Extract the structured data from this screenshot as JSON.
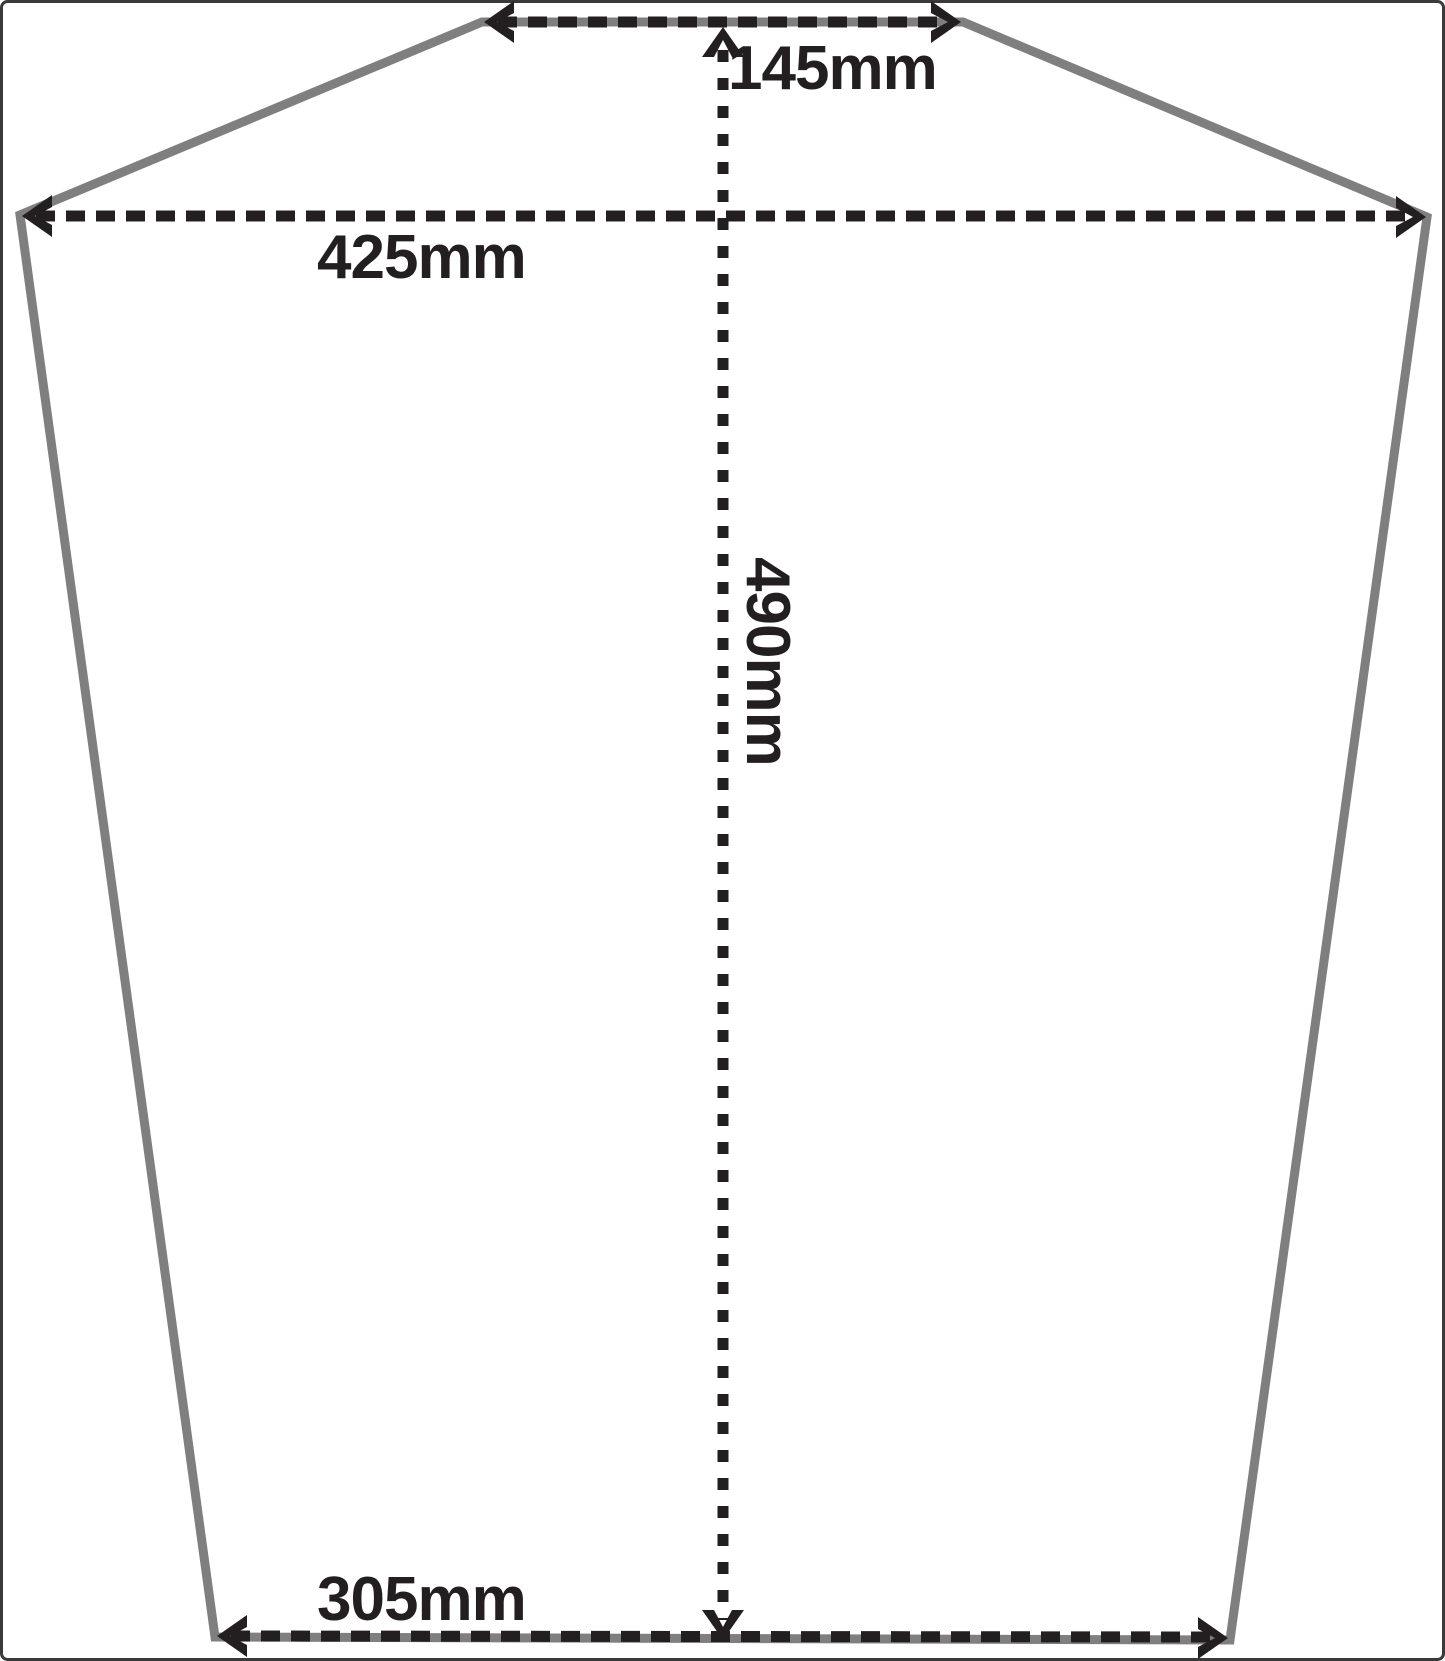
{
  "diagram": {
    "kind": "dimensioned panel template drawing",
    "measurements": {
      "top_edge": {
        "label": "145mm",
        "value_mm": 145
      },
      "upper_width": {
        "label": "425mm",
        "value_mm": 425
      },
      "height": {
        "label": "490mm",
        "value_mm": 490
      },
      "bottom_edge": {
        "label": "305mm",
        "value_mm": 305
      }
    },
    "colors": {
      "background": "#ffffff",
      "frame": "#3a3a3a",
      "outline": "#7f7f7f",
      "dimension": "#231f20",
      "text": "#231f20"
    }
  }
}
